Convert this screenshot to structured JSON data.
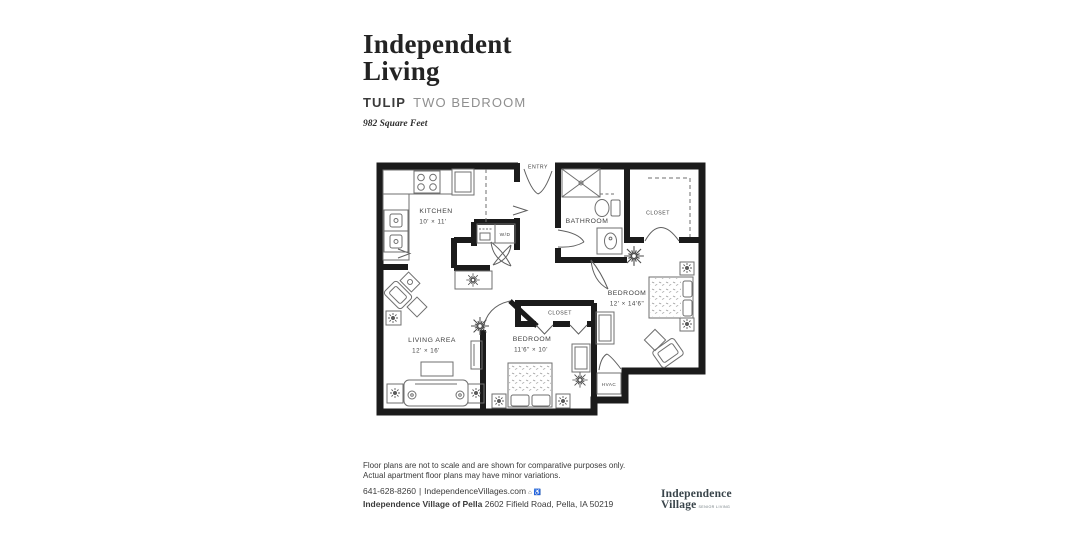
{
  "header": {
    "program_line1": "Independent",
    "program_line2": "Living",
    "plan_name": "TULIP",
    "plan_type": "TWO BEDROOM",
    "square_feet": "982 Square Feet"
  },
  "floorplan": {
    "entry_label": "ENTRY",
    "wd_label": "W/D",
    "hvac_label": "HVAC",
    "rooms": {
      "kitchen": {
        "name": "KITCHEN",
        "dims": "10' × 11'"
      },
      "bathroom": {
        "name": "BATHROOM"
      },
      "closet_top": {
        "name": "CLOSET"
      },
      "bedroom1": {
        "name": "BEDROOM",
        "dims": "12' × 14'6\""
      },
      "closet2": {
        "name": "CLOSET"
      },
      "bedroom2": {
        "name": "BEDROOM",
        "dims": "11'6\" × 10'"
      },
      "living": {
        "name": "LIVING AREA",
        "dims": "12' × 16'"
      }
    },
    "colors": {
      "wall": "#1b1b1b",
      "furniture": "#6f6f6f",
      "label": "#3f3f3f"
    }
  },
  "footer": {
    "disclaimer_line1": "Floor plans are not to scale and are shown for comparative purposes only.",
    "disclaimer_line2": "Actual apartment floor plans may have minor variations.",
    "phone": "641-628-8260",
    "separator": "|",
    "website": "IndependenceVillages.com",
    "icons": {
      "equal_housing": "⌂",
      "accessibility": "♿"
    },
    "address_name": "Independence Village of Pella",
    "address_rest": "2602 Fifield Road, Pella, IA 50219"
  },
  "logo": {
    "line1": "Independence",
    "line2": "Village",
    "tagline": "SENIOR LIVING"
  }
}
